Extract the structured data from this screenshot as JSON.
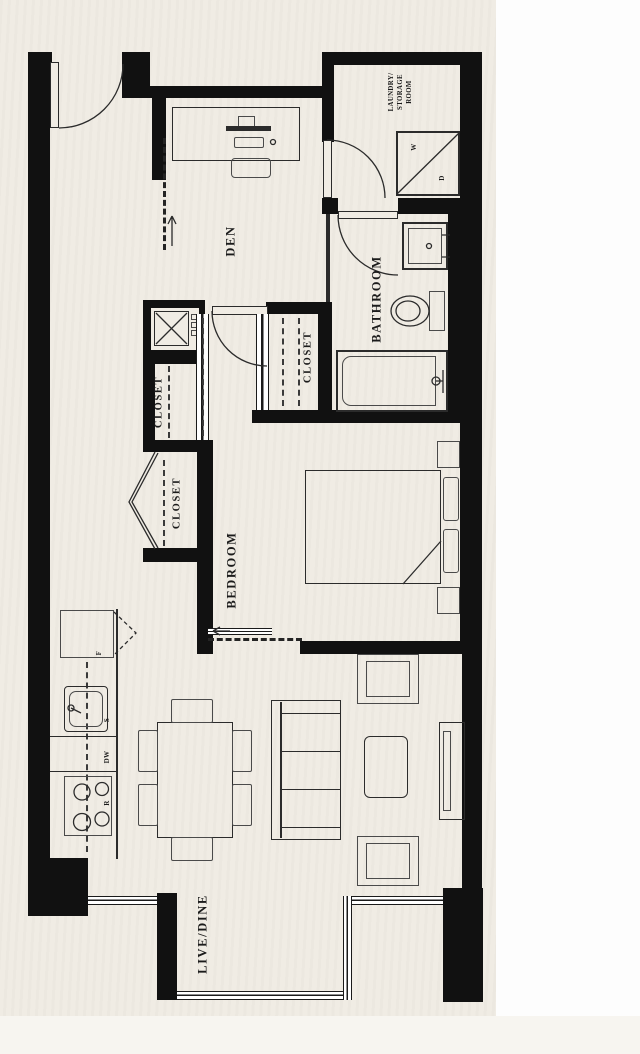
{
  "plan": {
    "rooms": {
      "den": "DEN",
      "bedroom": "BEDROOM",
      "bathroom": "BATHROOM",
      "live_dine": "LIVE/DINE",
      "laundry_storage": "LAUNDRY/\nSTORAGE\nROOM",
      "closet_hall_upper": "CLOSET",
      "closet_hall_lower": "CLOSET",
      "closet_bedroom": "CLOSET"
    },
    "fixtures": {
      "washer": "W",
      "dryer": "D",
      "fridge": "F",
      "sink": "S",
      "dishwasher": "DW",
      "range": "R"
    },
    "colors": {
      "paper": "#f0ece4",
      "wall": "#111111",
      "line": "#2b2b2b",
      "text": "#1b1b1b",
      "margin": "#fdfdfd"
    }
  }
}
